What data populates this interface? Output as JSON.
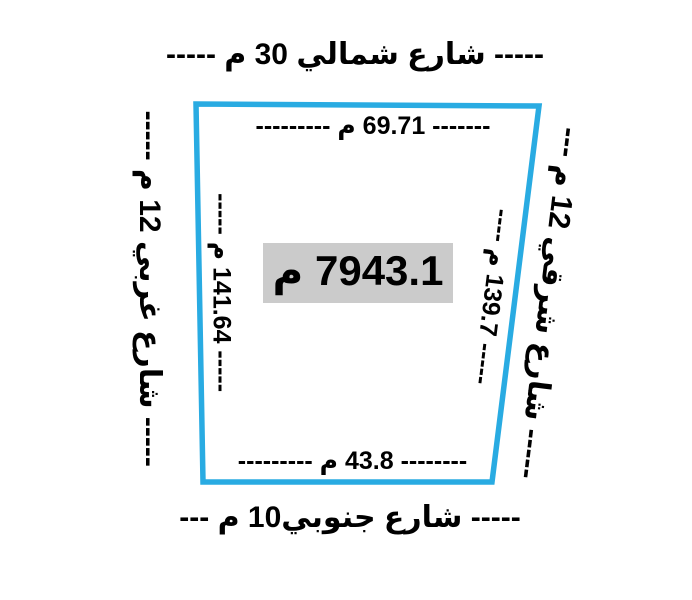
{
  "colors": {
    "boundary": "#29ABE2",
    "area_bg": "#CBCBCB",
    "text": "#000000"
  },
  "plot": {
    "area_label": "7943.1 م",
    "streets": {
      "north": "----- شارع شمالي 30 م -----",
      "south": "----- شارع جنوبي10 م ---",
      "west": "----- شارع غربي 12 م -----",
      "east": "----- شارع شرقي 12 م ---"
    },
    "dimensions": {
      "north": "------- 69.71 م ---------",
      "south": "-------- 43.8 م ---------",
      "west": "----- 141.64 م -----",
      "east": "----- 139.7 م ----"
    },
    "measurements": {
      "top_side_m": 69.71,
      "bottom_side_m": 43.8,
      "left_side_m": 141.64,
      "right_side_m": 139.7,
      "area_sq_m": 7943.1,
      "north_street_width_m": 30,
      "south_street_width_m": 10,
      "west_street_width_m": 12,
      "east_street_width_m": 12
    }
  }
}
